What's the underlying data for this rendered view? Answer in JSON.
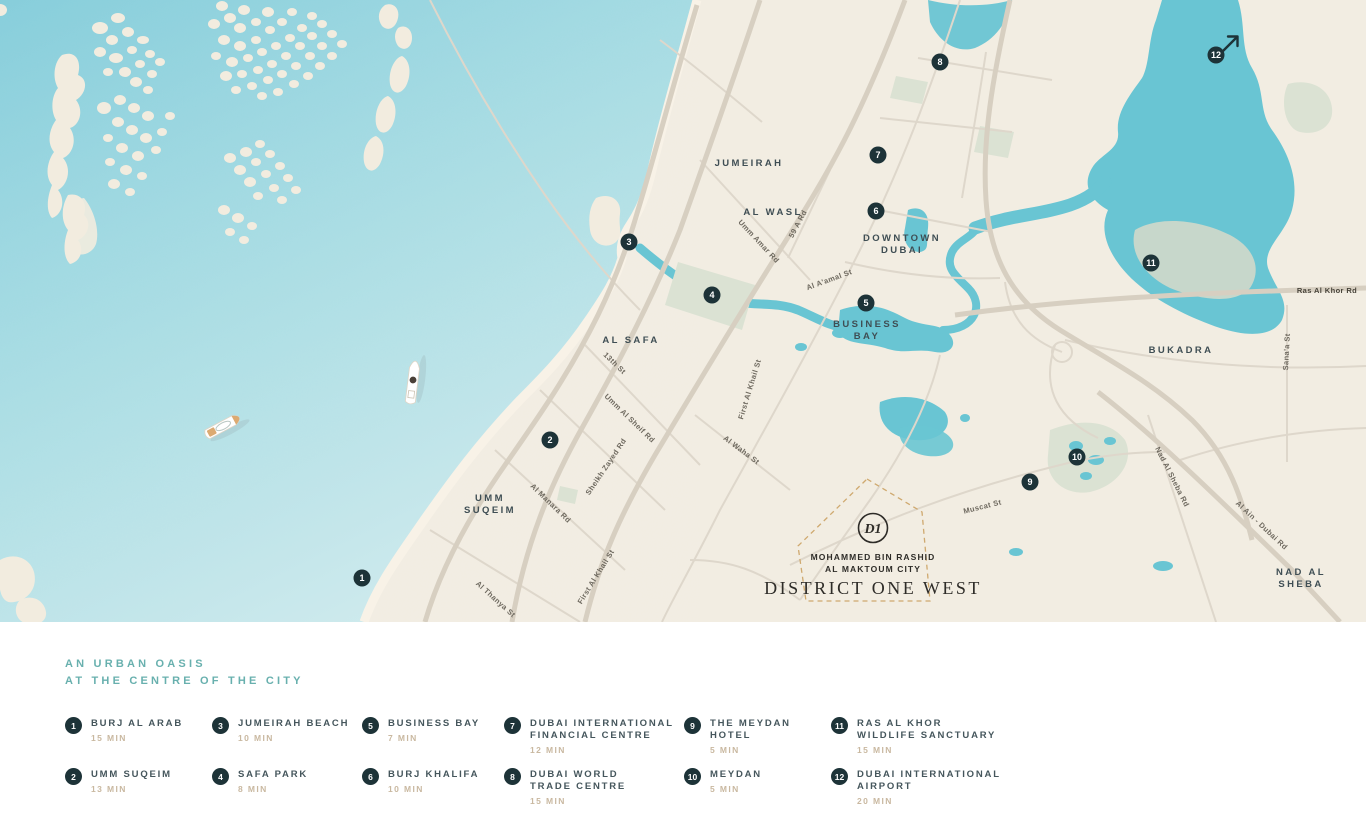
{
  "colors": {
    "land": "#f2ede2",
    "sea_deep": "#85cdda",
    "sea_light": "#cdeaed",
    "inland_water": "#69c5d3",
    "park": "#dbe2d3",
    "wetland": "#ccd8ca",
    "road": "#d7cfc1",
    "road_minor": "#ded7cb",
    "beach": "#f8f2e7",
    "marker": "#1d3338",
    "boundary_dash": "#cfa96f",
    "heading_teal": "#68b0ae",
    "legend_name": "#45565c",
    "legend_time": "#c9b8a0"
  },
  "map": {
    "area_labels": [
      {
        "lines": [
          "JUMEIRAH"
        ],
        "x": 749,
        "y": 166
      },
      {
        "lines": [
          "AL WASL"
        ],
        "x": 773,
        "y": 215
      },
      {
        "lines": [
          "DOWNTOWN",
          "DUBAI"
        ],
        "x": 902,
        "y": 241
      },
      {
        "lines": [
          "BUSINESS",
          "BAY"
        ],
        "x": 867,
        "y": 327
      },
      {
        "lines": [
          "AL SAFA"
        ],
        "x": 631,
        "y": 343
      },
      {
        "lines": [
          "UMM",
          "SUQEIM"
        ],
        "x": 490,
        "y": 501
      },
      {
        "lines": [
          "BUKADRA"
        ],
        "x": 1181,
        "y": 353
      },
      {
        "lines": [
          "NAD AL",
          "SHEBA"
        ],
        "x": 1301,
        "y": 575
      }
    ],
    "road_labels": [
      {
        "text": "Umm Amar Rd",
        "x": 757,
        "y": 243,
        "rot": 47
      },
      {
        "text": "59 A Rd",
        "x": 800,
        "y": 225,
        "rot": -62
      },
      {
        "text": "Al A'amal St",
        "x": 830,
        "y": 282,
        "rot": -20
      },
      {
        "text": "13th St",
        "x": 613,
        "y": 365,
        "rot": 44
      },
      {
        "text": "Umm Al Sheif Rd",
        "x": 628,
        "y": 420,
        "rot": 44
      },
      {
        "text": "Sheikh Zayed Rd",
        "x": 608,
        "y": 468,
        "rot": -56
      },
      {
        "text": "Al Manara Rd",
        "x": 549,
        "y": 505,
        "rot": 44
      },
      {
        "text": "First Al Khail St",
        "x": 752,
        "y": 390,
        "rot": -73
      },
      {
        "text": "Al Waha St",
        "x": 740,
        "y": 452,
        "rot": 37
      },
      {
        "text": "First Al Khail St",
        "x": 598,
        "y": 578,
        "rot": -58
      },
      {
        "text": "Al Thanya St",
        "x": 494,
        "y": 601,
        "rot": 42
      },
      {
        "text": "Muscat St",
        "x": 983,
        "y": 509,
        "rot": -14
      },
      {
        "text": "Nad Al Sheba Rd",
        "x": 1170,
        "y": 478,
        "rot": 63
      },
      {
        "text": "Al Ain - Dubai Rd",
        "x": 1260,
        "y": 527,
        "rot": 43
      },
      {
        "text": "Sana'a St",
        "x": 1289,
        "y": 352,
        "rot": -87
      },
      {
        "text": "Ras Al Khor Rd",
        "x": 1327,
        "y": 293,
        "rot": 0,
        "bold": true
      }
    ],
    "markers": [
      {
        "num": "1",
        "x": 362,
        "y": 578
      },
      {
        "num": "2",
        "x": 550,
        "y": 440
      },
      {
        "num": "3",
        "x": 629,
        "y": 242
      },
      {
        "num": "4",
        "x": 712,
        "y": 295
      },
      {
        "num": "5",
        "x": 866,
        "y": 303
      },
      {
        "num": "6",
        "x": 876,
        "y": 211
      },
      {
        "num": "7",
        "x": 878,
        "y": 155
      },
      {
        "num": "8",
        "x": 940,
        "y": 62
      },
      {
        "num": "9",
        "x": 1030,
        "y": 482
      },
      {
        "num": "10",
        "x": 1077,
        "y": 457
      },
      {
        "num": "11",
        "x": 1151,
        "y": 263
      },
      {
        "num": "12",
        "x": 1216,
        "y": 55
      }
    ],
    "logo": {
      "monogram": "D1",
      "line1": "MOHAMMED BIN RASHID",
      "line2": "AL MAKTOUM CITY",
      "line3": "District One West"
    }
  },
  "legend": {
    "heading": [
      "AN URBAN OASIS",
      "AT THE CENTRE OF THE CITY"
    ],
    "items": [
      {
        "num": "1",
        "name_lines": [
          "BURJ AL ARAB"
        ],
        "time": "15 MIN"
      },
      {
        "num": "2",
        "name_lines": [
          "UMM SUQEIM"
        ],
        "time": "13 MIN"
      },
      {
        "num": "3",
        "name_lines": [
          "JUMEIRAH BEACH"
        ],
        "time": "10 MIN"
      },
      {
        "num": "4",
        "name_lines": [
          "SAFA PARK"
        ],
        "time": "8 MIN"
      },
      {
        "num": "5",
        "name_lines": [
          "BUSINESS BAY"
        ],
        "time": "7 MIN"
      },
      {
        "num": "6",
        "name_lines": [
          "BURJ KHALIFA"
        ],
        "time": "10 MIN"
      },
      {
        "num": "7",
        "name_lines": [
          "DUBAI INTERNATIONAL",
          "FINANCIAL CENTRE"
        ],
        "time": "12 MIN"
      },
      {
        "num": "8",
        "name_lines": [
          "DUBAI WORLD",
          "TRADE CENTRE"
        ],
        "time": "15 MIN"
      },
      {
        "num": "9",
        "name_lines": [
          "THE MEYDAN",
          "HOTEL"
        ],
        "time": "5 MIN"
      },
      {
        "num": "10",
        "name_lines": [
          "MEYDAN"
        ],
        "time": "5 MIN"
      },
      {
        "num": "11",
        "name_lines": [
          "RAS AL KHOR",
          "WILDLIFE SANCTUARY"
        ],
        "time": "15 MIN"
      },
      {
        "num": "12",
        "name_lines": [
          "DUBAI INTERNATIONAL",
          "AIRPORT"
        ],
        "time": "20 MIN"
      }
    ]
  }
}
